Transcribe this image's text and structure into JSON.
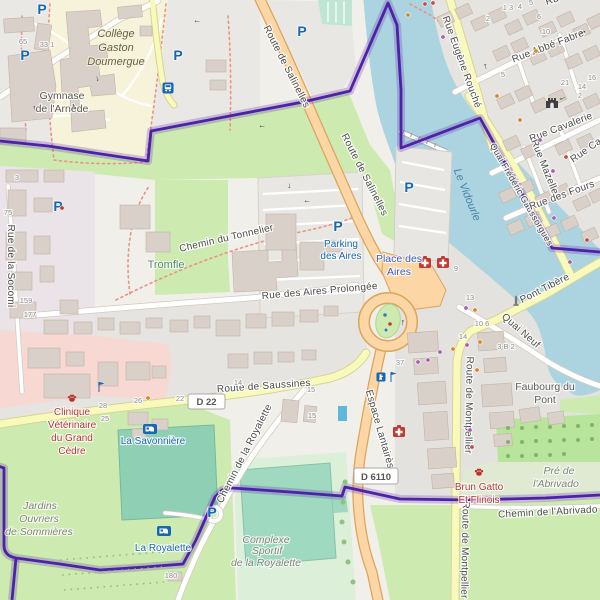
{
  "roads": {
    "route_de_salinelles": "Route de Salinelles",
    "rue_eugene_rouche": "Rue Eugène Rouché",
    "quai_frederic_gaussorgues": "Quai Frédéric Gaussorgues",
    "rue_abbe_fabre": "Rue Abbé Fabre",
    "rue_cavalerie": "Rue Cavalerie",
    "rue_mazelle": "Rue Mazelle",
    "rue_cau_partial": "Rue Cau",
    "rue_des_fours": "Rue des Fours",
    "pont_tibere": "Pont Tibère",
    "quai_neuf": "Quai Neuf",
    "route_de_saussines": "Route de Saussines",
    "chemin_de_la_royalette": "Chemin de la Royalette",
    "espace_lantaires": "Espace Lantairès",
    "route_de_montpellier": "Route de Montpellier",
    "chemin_de_l_abrivado": "Chemin de l'Abrivado",
    "rue_des_aires_prolongee": "Rue des Aires Prolongée",
    "chemin_du_tonnelier": "Chemin du Tonnelier",
    "rue_de_la_socomi": "Rue de la Socomi",
    "rue_partial_top": "Ru"
  },
  "badges": {
    "d22": "D 22",
    "d6110": "D 6110"
  },
  "places": {
    "college": {
      "line1": "Collège",
      "line2": "Gaston",
      "line3": "Doumergue"
    },
    "gymnase": {
      "line1": "Gymnase",
      "line2": "de l'Arnède"
    },
    "tromfle": "Tromfle",
    "parking_des_aires": {
      "line1": "Parking",
      "line2": "des Aires"
    },
    "place_des_aires": {
      "line1": "Place des",
      "line2": "Aires"
    },
    "la_savonniere": "La Savonnière",
    "la_royalette": "La Royalette",
    "le_vidourle": "Le Vidourle",
    "faubourg_du_pont": {
      "line1": "Faubourg du",
      "line2": "Pont"
    },
    "pre_de_l_abrivado": {
      "line1": "Pré de",
      "line2": "l'Abrivado"
    },
    "jardins_ouvriers": {
      "line1": "Jardins",
      "line2": "Ouvriers",
      "line3": "de Sommières"
    },
    "complexe_sportif": {
      "line1": "Complexe",
      "line2": "Sportif",
      "line3": "de la Royalette"
    }
  },
  "pois": {
    "clinique_veterinaire": {
      "line1": "Clinique",
      "line2": "Vétérinaire",
      "line3": "du Grand",
      "line4": "Cèdre"
    },
    "brun_gatto": {
      "line1": "Brun Gatto",
      "line2": "Et Flinois"
    }
  },
  "icons": {
    "parking": "P",
    "oneway_arrow": "→",
    "bus_stop": "bus-icon",
    "caravan_site": "caravan-icon",
    "first_aid": "first-aid-icon",
    "veterinary_paw": "paw-icon",
    "city_gate": "castle-icon",
    "monument": "monument-icon",
    "drinking_water": "drinking-water-icon",
    "flag": "flag-icon"
  },
  "house_numbers": [
    {
      "t": "3",
      "x": 17,
      "y": 180
    },
    {
      "t": "65",
      "x": 23,
      "y": 44
    },
    {
      "t": "33 1",
      "x": 47,
      "y": 47
    },
    {
      "t": "75",
      "x": 8,
      "y": 215
    },
    {
      "t": "159",
      "x": 26,
      "y": 303
    },
    {
      "t": "177",
      "x": 30,
      "y": 317
    },
    {
      "t": "28",
      "x": 103,
      "y": 408
    },
    {
      "t": "25",
      "x": 105,
      "y": 421
    },
    {
      "t": "26",
      "x": 138,
      "y": 403
    },
    {
      "t": "22",
      "x": 180,
      "y": 401
    },
    {
      "t": "14",
      "x": 238,
      "y": 385
    },
    {
      "t": "15",
      "x": 311,
      "y": 392
    },
    {
      "t": "15",
      "x": 312,
      "y": 418
    },
    {
      "t": "180",
      "x": 171,
      "y": 578
    },
    {
      "t": "37",
      "x": 400,
      "y": 365
    },
    {
      "t": "9",
      "x": 456,
      "y": 271
    },
    {
      "t": "13",
      "x": 470,
      "y": 300
    },
    {
      "t": "10 6",
      "x": 482,
      "y": 326
    },
    {
      "t": "14",
      "x": 463,
      "y": 339
    },
    {
      "t": "3 B 2",
      "x": 506,
      "y": 349
    },
    {
      "t": "6",
      "x": 539,
      "y": 19
    },
    {
      "t": "10",
      "x": 546,
      "y": 34
    },
    {
      "t": "21",
      "x": 565,
      "y": 85
    },
    {
      "t": "16",
      "x": 592,
      "y": 80
    },
    {
      "t": "14",
      "x": 582,
      "y": 89
    },
    {
      "t": "2",
      "x": 580,
      "y": 98
    },
    {
      "t": "5",
      "x": 503,
      "y": 77
    },
    {
      "t": "1 3",
      "x": 508,
      "y": 10
    },
    {
      "t": "4",
      "x": 520,
      "y": 9
    },
    {
      "t": "2",
      "x": 488,
      "y": 21
    },
    {
      "t": "5",
      "x": 531,
      "y": 5
    }
  ],
  "poi_dots": [
    {
      "x": 408,
      "y": 15,
      "c": "#d4872a"
    },
    {
      "x": 425,
      "y": 4,
      "c": "#c44c44"
    },
    {
      "x": 433,
      "y": 3,
      "c": "#c44c44"
    },
    {
      "x": 443,
      "y": 37,
      "c": "#a85fb0"
    },
    {
      "x": 536,
      "y": 51,
      "c": "#d4872a"
    },
    {
      "x": 553,
      "y": 171,
      "c": "#a85fb0"
    },
    {
      "x": 566,
      "y": 157,
      "c": "#c44c44"
    },
    {
      "x": 497,
      "y": 96,
      "c": "#d4872a"
    },
    {
      "x": 418,
      "y": 362,
      "c": "#a85fb0"
    },
    {
      "x": 428,
      "y": 360,
      "c": "#a85fb0"
    },
    {
      "x": 440,
      "y": 352,
      "c": "#a85fb0"
    },
    {
      "x": 453,
      "y": 349,
      "c": "#d4872a"
    },
    {
      "x": 467,
      "y": 345,
      "c": "#a85fb0"
    },
    {
      "x": 480,
      "y": 342,
      "c": "#d4872a"
    },
    {
      "x": 470,
      "y": 430,
      "c": "#a85fb0"
    },
    {
      "x": 472,
      "y": 447,
      "c": "#c44c44"
    },
    {
      "x": 477,
      "y": 370,
      "c": "#d4872a"
    },
    {
      "x": 540,
      "y": 140,
      "c": "#a85fb0"
    },
    {
      "x": 520,
      "y": 120,
      "c": "#d4872a"
    },
    {
      "x": 148,
      "y": 398,
      "c": "#d4872a"
    },
    {
      "x": 62,
      "y": 208,
      "c": "#c23b32"
    },
    {
      "x": 554,
      "y": 218,
      "c": "#a85fb0"
    },
    {
      "x": 587,
      "y": 240,
      "c": "#c44c44"
    },
    {
      "x": 466,
      "y": 308,
      "c": "#a85fb0"
    },
    {
      "x": 475,
      "y": 310,
      "c": "#d4872a"
    },
    {
      "x": 570,
      "y": 262,
      "c": "#a85fb0"
    }
  ],
  "oneway_arrows": [
    {
      "x": 487,
      "y": 66,
      "r": -105,
      "s": 9
    },
    {
      "x": 583,
      "y": 34,
      "r": -21,
      "s": 10
    },
    {
      "x": 562,
      "y": 97,
      "r": 159,
      "s": 9
    },
    {
      "x": 404,
      "y": 323,
      "r": -80,
      "s": 9
    },
    {
      "x": 96,
      "y": 79,
      "r": 75,
      "s": 8
    },
    {
      "x": 36,
      "y": 108,
      "r": -105,
      "s": 8
    },
    {
      "x": 75,
      "y": 106,
      "r": -105,
      "s": 8
    },
    {
      "x": 197,
      "y": 20,
      "r": 180,
      "s": 8
    },
    {
      "x": 307,
      "y": 200,
      "r": 180,
      "s": 8
    },
    {
      "x": 288,
      "y": 186,
      "r": 90,
      "s": 8
    },
    {
      "x": 262,
      "y": 125,
      "r": 180,
      "s": 8
    }
  ],
  "colors": {
    "boundary_purple": "#4b22a8",
    "water_blue": "#abd4e0",
    "grass_green": "#cdebb0",
    "pitch_teal": "#9fd9bf",
    "primary_road": "#fcd6a4",
    "secondary_road": "#f8fabc",
    "school_yellow": "#f7f3da",
    "retail_pink": "#f7d8d2",
    "poi_blue": "#1767b3",
    "poi_red": "#bb352c"
  }
}
